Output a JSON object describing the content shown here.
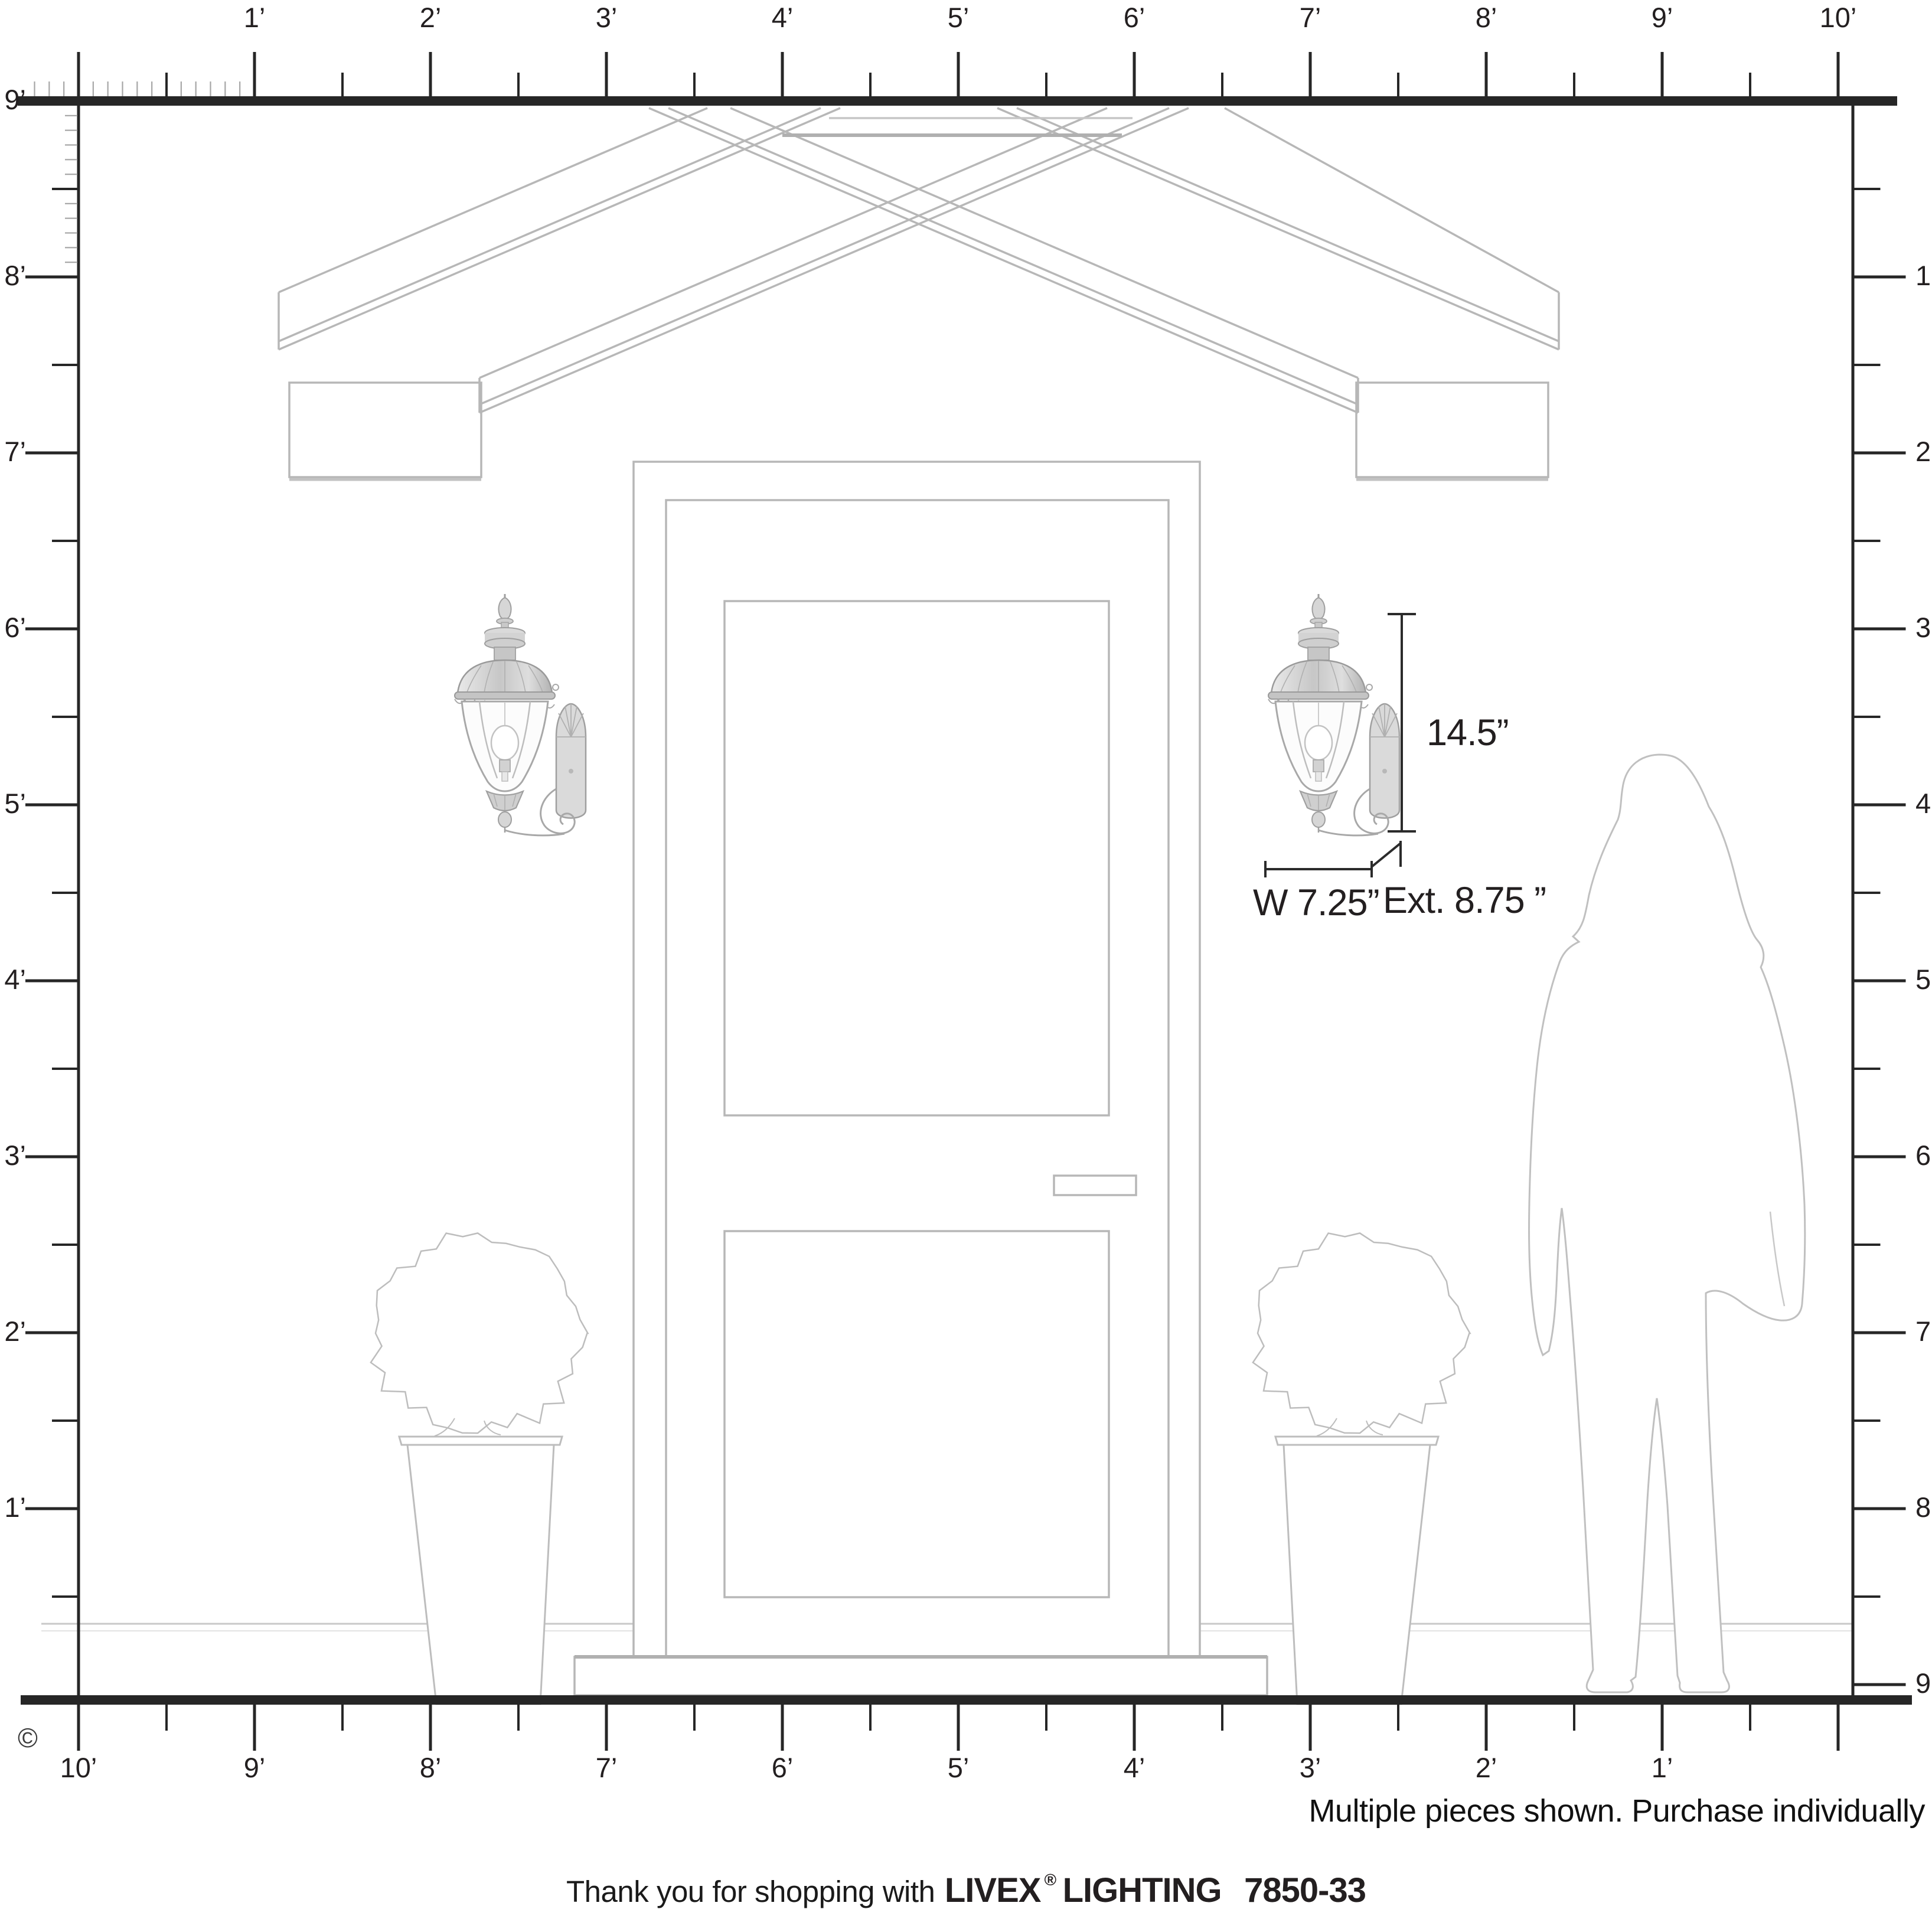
{
  "diagram": {
    "copyright": "©",
    "disclaimer": "Multiple pieces shown. Purchase individually",
    "footer": {
      "prefix": "Thank you for shopping with",
      "brand": "LIVEX",
      "registered": "®",
      "brand_suffix": "LIGHTING",
      "model": "7850-33"
    },
    "annotations": {
      "height": "14.5”",
      "width": "W 7.25”",
      "extension": "Ext. 8.75 ”"
    },
    "rulers": {
      "top": {
        "labels": [
          "1’",
          "2’",
          "3’",
          "4’",
          "5’",
          "6’",
          "7’",
          "8’",
          "9’",
          "10’"
        ]
      },
      "left": {
        "labels": [
          "9’",
          "8’",
          "7’",
          "6’",
          "5’",
          "4’",
          "3’",
          "2’",
          "1’"
        ]
      },
      "right": {
        "labels": [
          "1’",
          "2’",
          "3’",
          "4’",
          "5’",
          "6’",
          "7’",
          "8’",
          "9’"
        ]
      },
      "bottom": {
        "labels": [
          "10’",
          "9’",
          "8’",
          "7’",
          "6’",
          "5’",
          "4’",
          "3’",
          "2’",
          "1’"
        ]
      }
    },
    "colors": {
      "ruler": "#262626",
      "inch_tick": "#a6a6a6",
      "illustration_line": "#b7b7b7",
      "dimension_line": "#2b2b2b",
      "text": "#231f20"
    }
  }
}
